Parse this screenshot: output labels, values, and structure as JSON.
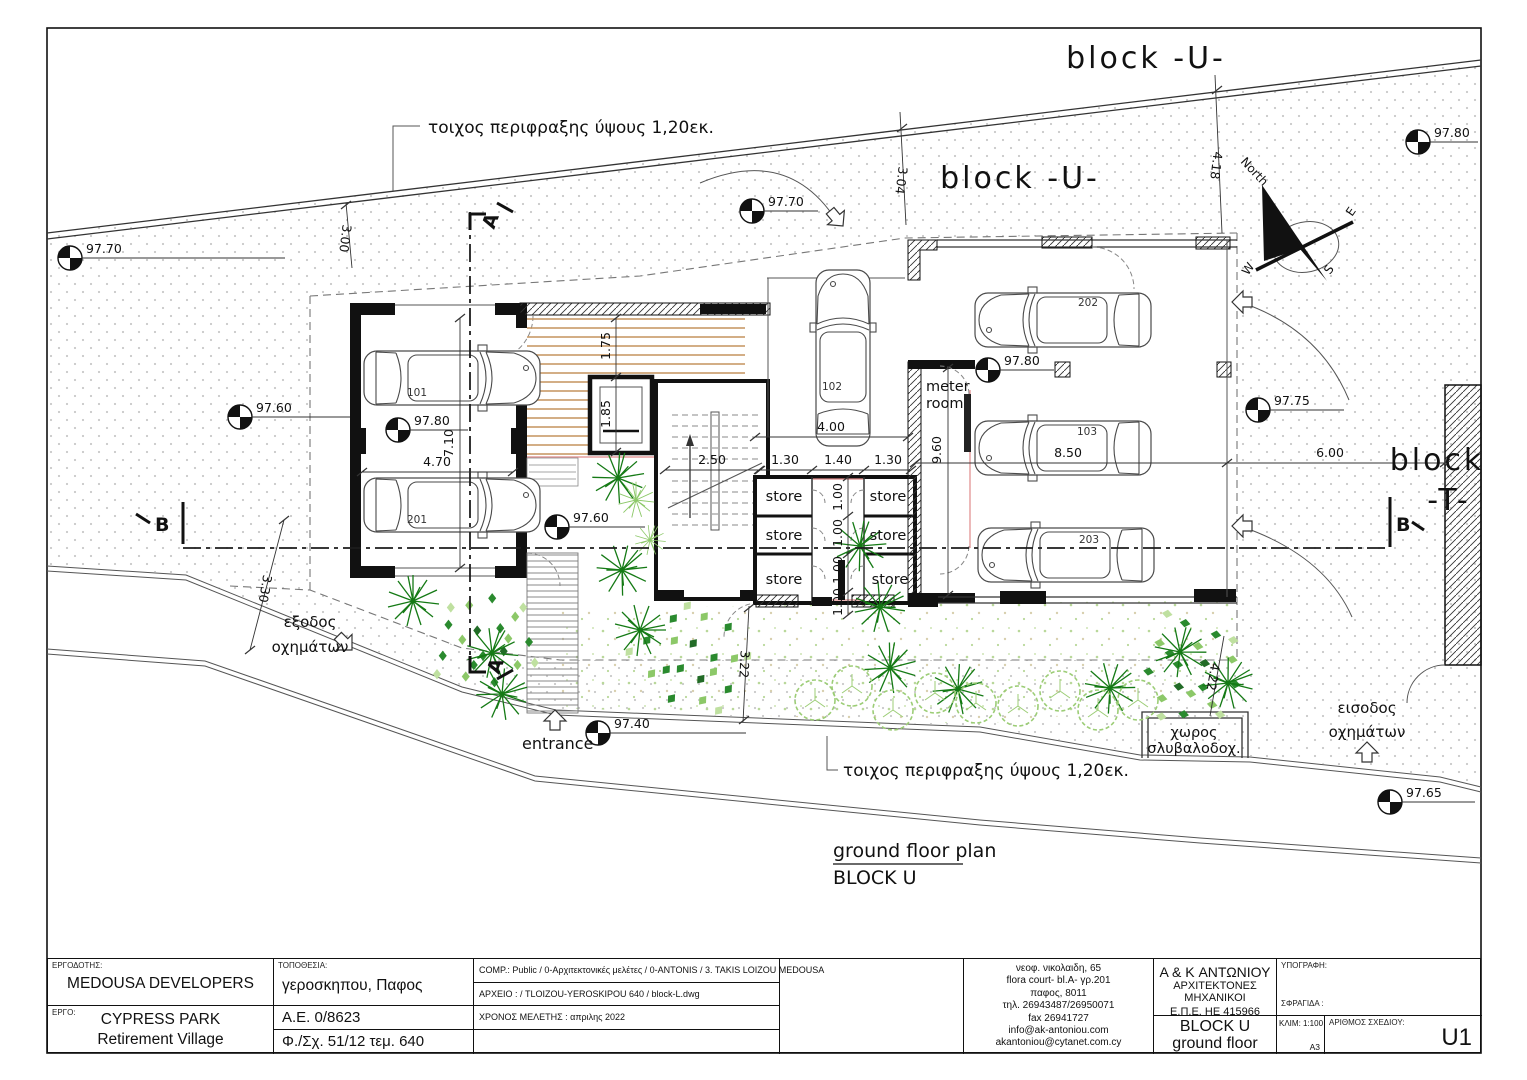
{
  "drawing": {
    "block_u_top": "block  -U-",
    "block_u_inner": "block  -U-",
    "block_t_line1": "block",
    "block_t_line2": "-T-",
    "fence_label": "τοιχος περιφραξης ύψους 1,20εκ.",
    "exit_line1": "εξοδος",
    "exit_line2": "οχημάτων",
    "entry_line1": "εισοδος",
    "entry_line2": "οχημάτων",
    "bins_line1": "χωρος",
    "bins_line2": "σλυβαλοδοχ.",
    "entrance": "entrance",
    "plan_title_line1": "ground floor plan",
    "plan_title_line2": "BLOCK U",
    "meter_line1": "meter",
    "meter_line2": "room",
    "store": "store",
    "north": "North",
    "compass_e": "E",
    "compass_w": "W",
    "compass_s": "S",
    "section_a": "A",
    "section_b": "B"
  },
  "levels": {
    "site_nw": "97.70",
    "site_top": "97.70",
    "site_ne": "97.80",
    "left_outside": "97.60",
    "garage": "97.80",
    "walkway": "97.60",
    "carport": "97.80",
    "east": "97.75",
    "entrance": "97.40",
    "road": "97.65"
  },
  "dims": {
    "d300": "3.00",
    "d304": "3.04",
    "d418": "4.18",
    "d175": "1.75",
    "d185": "1.85",
    "d470": "4.70",
    "d710": "7.10",
    "d250": "2.50",
    "d130": "1.30",
    "d140": "1.40",
    "d100": "1.00",
    "d400": "4.00",
    "d960": "9.60",
    "d850": "8.50",
    "d600": "6.00",
    "d330": "3.30",
    "d322": "3.22",
    "d422": "4.22"
  },
  "cars": {
    "c101": "101",
    "c201": "201",
    "c102": "102",
    "c202": "202",
    "c103": "103",
    "c203": "203"
  },
  "titleblock": {
    "client_label": "ΕΡΓΟΔΟΤΗΣ:",
    "client": "MEDOUSA  DEVELOPERS",
    "location_label": "ΤΟΠΟΘΕΣΙΑ:",
    "location": "γεροσκηπου, Παφος",
    "project_label": "ΕΡΓΟ:",
    "project_line1": "CYPRESS PARK",
    "project_line2": "Retirement Village",
    "ae": "Α.Ε. 0/8623",
    "sheet": "Φ./Σχ. 51/12   τεμ. 640",
    "comp": "COMP.: Public / 0-Αρχιτεκτονικές μελέτες / 0-ANTONIS / 3. TAKIS LOIZOU MEDOUSA",
    "file": "ΑΡΧΕΙΟ :   / TLOIZOU-YEROSKIPOU 640 / block-L.dwg",
    "study": "ΧΡΟΝΟΣ ΜΕΛΕΤΗΣ :   απριλης 2022",
    "address": [
      "νεοφ. νικολαιδη, 65",
      "flora court- bl.A- γρ.201",
      "παφος, 8011",
      "τηλ. 26943487/26950071",
      "fax  26941727",
      "info@ak-antoniou.com",
      "akantoniou@cytanet.com.cy"
    ],
    "firm_line1": "A & K ΑΝΤΩΝΙΟΥ",
    "firm_line2": "ΑΡΧΙΤΕΚΤΟΝΕΣ ΜΗΧΑΝΙΚΟΙ",
    "firm_line3": "Ε.Π.Ε.    HE 415966",
    "signature_label": "ΥΠΟΓΡΑΦΗ:",
    "stamp_label": "ΣΦΡΑΓΙΔΑ :",
    "drawing_line1": "BLOCK U",
    "drawing_line2": "ground floor",
    "scale_label": "ΚΛΙΜ: 1:100",
    "paper": "A3",
    "number_label": "ΑΡΙΘΜΟΣ ΣΧΕΔΙΟΥ:",
    "number": "U1"
  }
}
